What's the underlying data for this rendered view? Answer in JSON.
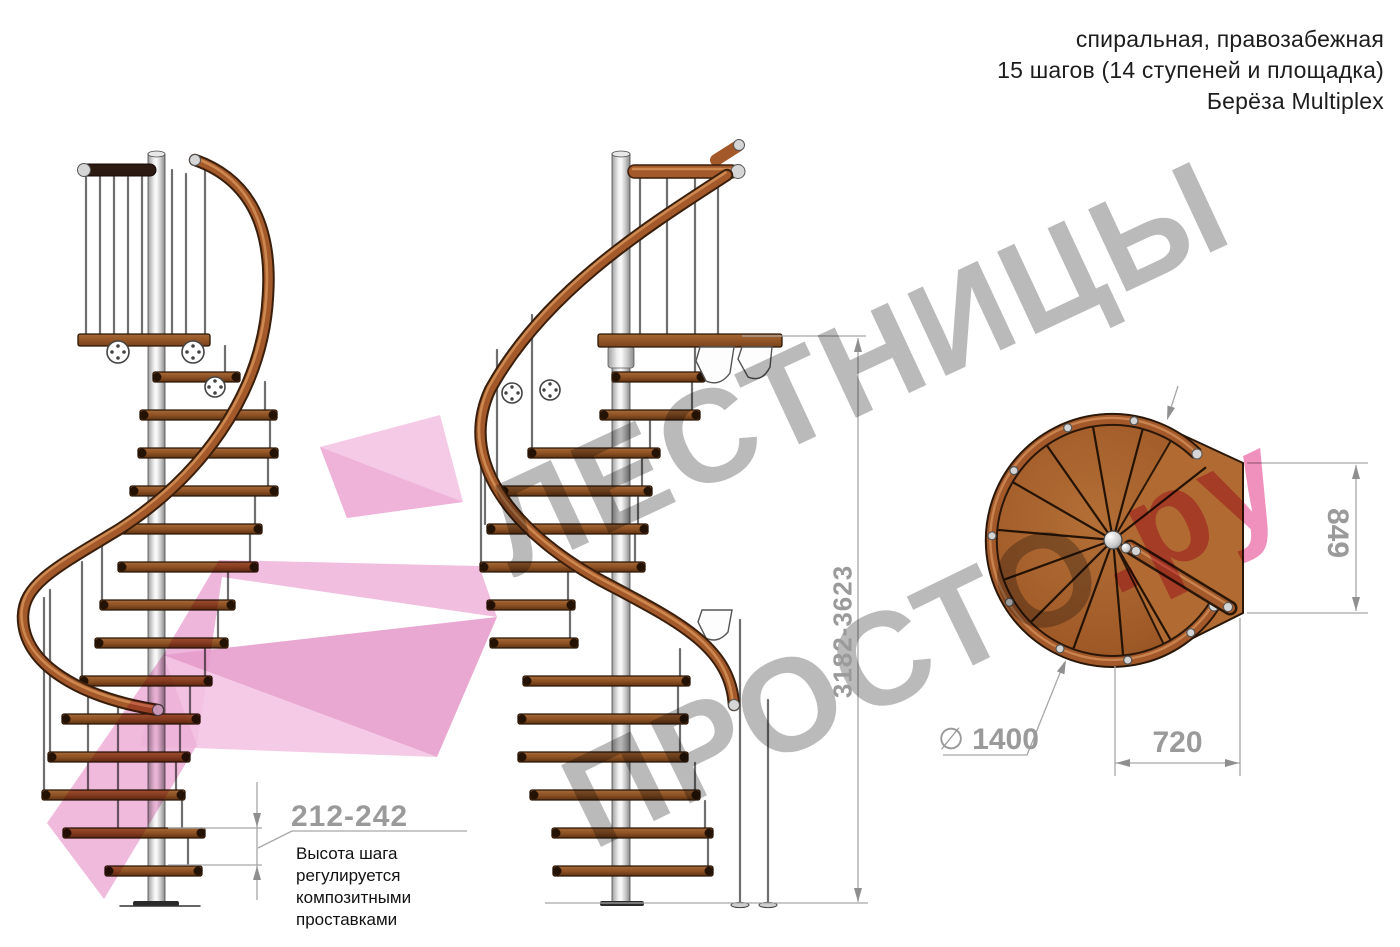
{
  "header": {
    "lines": [
      "спиральная, правозабежная",
      "15 шагов (14 ступеней и площадка)",
      "Берёза Multiplex"
    ]
  },
  "watermark": {
    "line1": "ЛЕСТНИЦЫ",
    "line2_gray": "ПРОСТО",
    "line2_pink": ".ру"
  },
  "dimensions": {
    "total_height": "3182-3623",
    "step_height": "212-242",
    "step_height_note": [
      "Высота шага",
      "регулируется",
      "композитными",
      "проставками"
    ],
    "plan_height": "849",
    "plan_width": "720",
    "diameter_symbol": "∅",
    "diameter_value": "1400"
  },
  "colors": {
    "watermark_gray": "#a9a9a9",
    "watermark_pink": "#ec74ab",
    "arrow_pink_light": "#f4c4e3",
    "arrow_pink_mid": "#eeb0d8",
    "arrow_pink_dark": "#e79fcc",
    "dimension_gray": "#9a9a9a",
    "wood_rail": "#a4592a",
    "wood_tread_dark": "#5f3312",
    "metal": "#d6d6d6",
    "text_black": "#1d1d1d"
  }
}
